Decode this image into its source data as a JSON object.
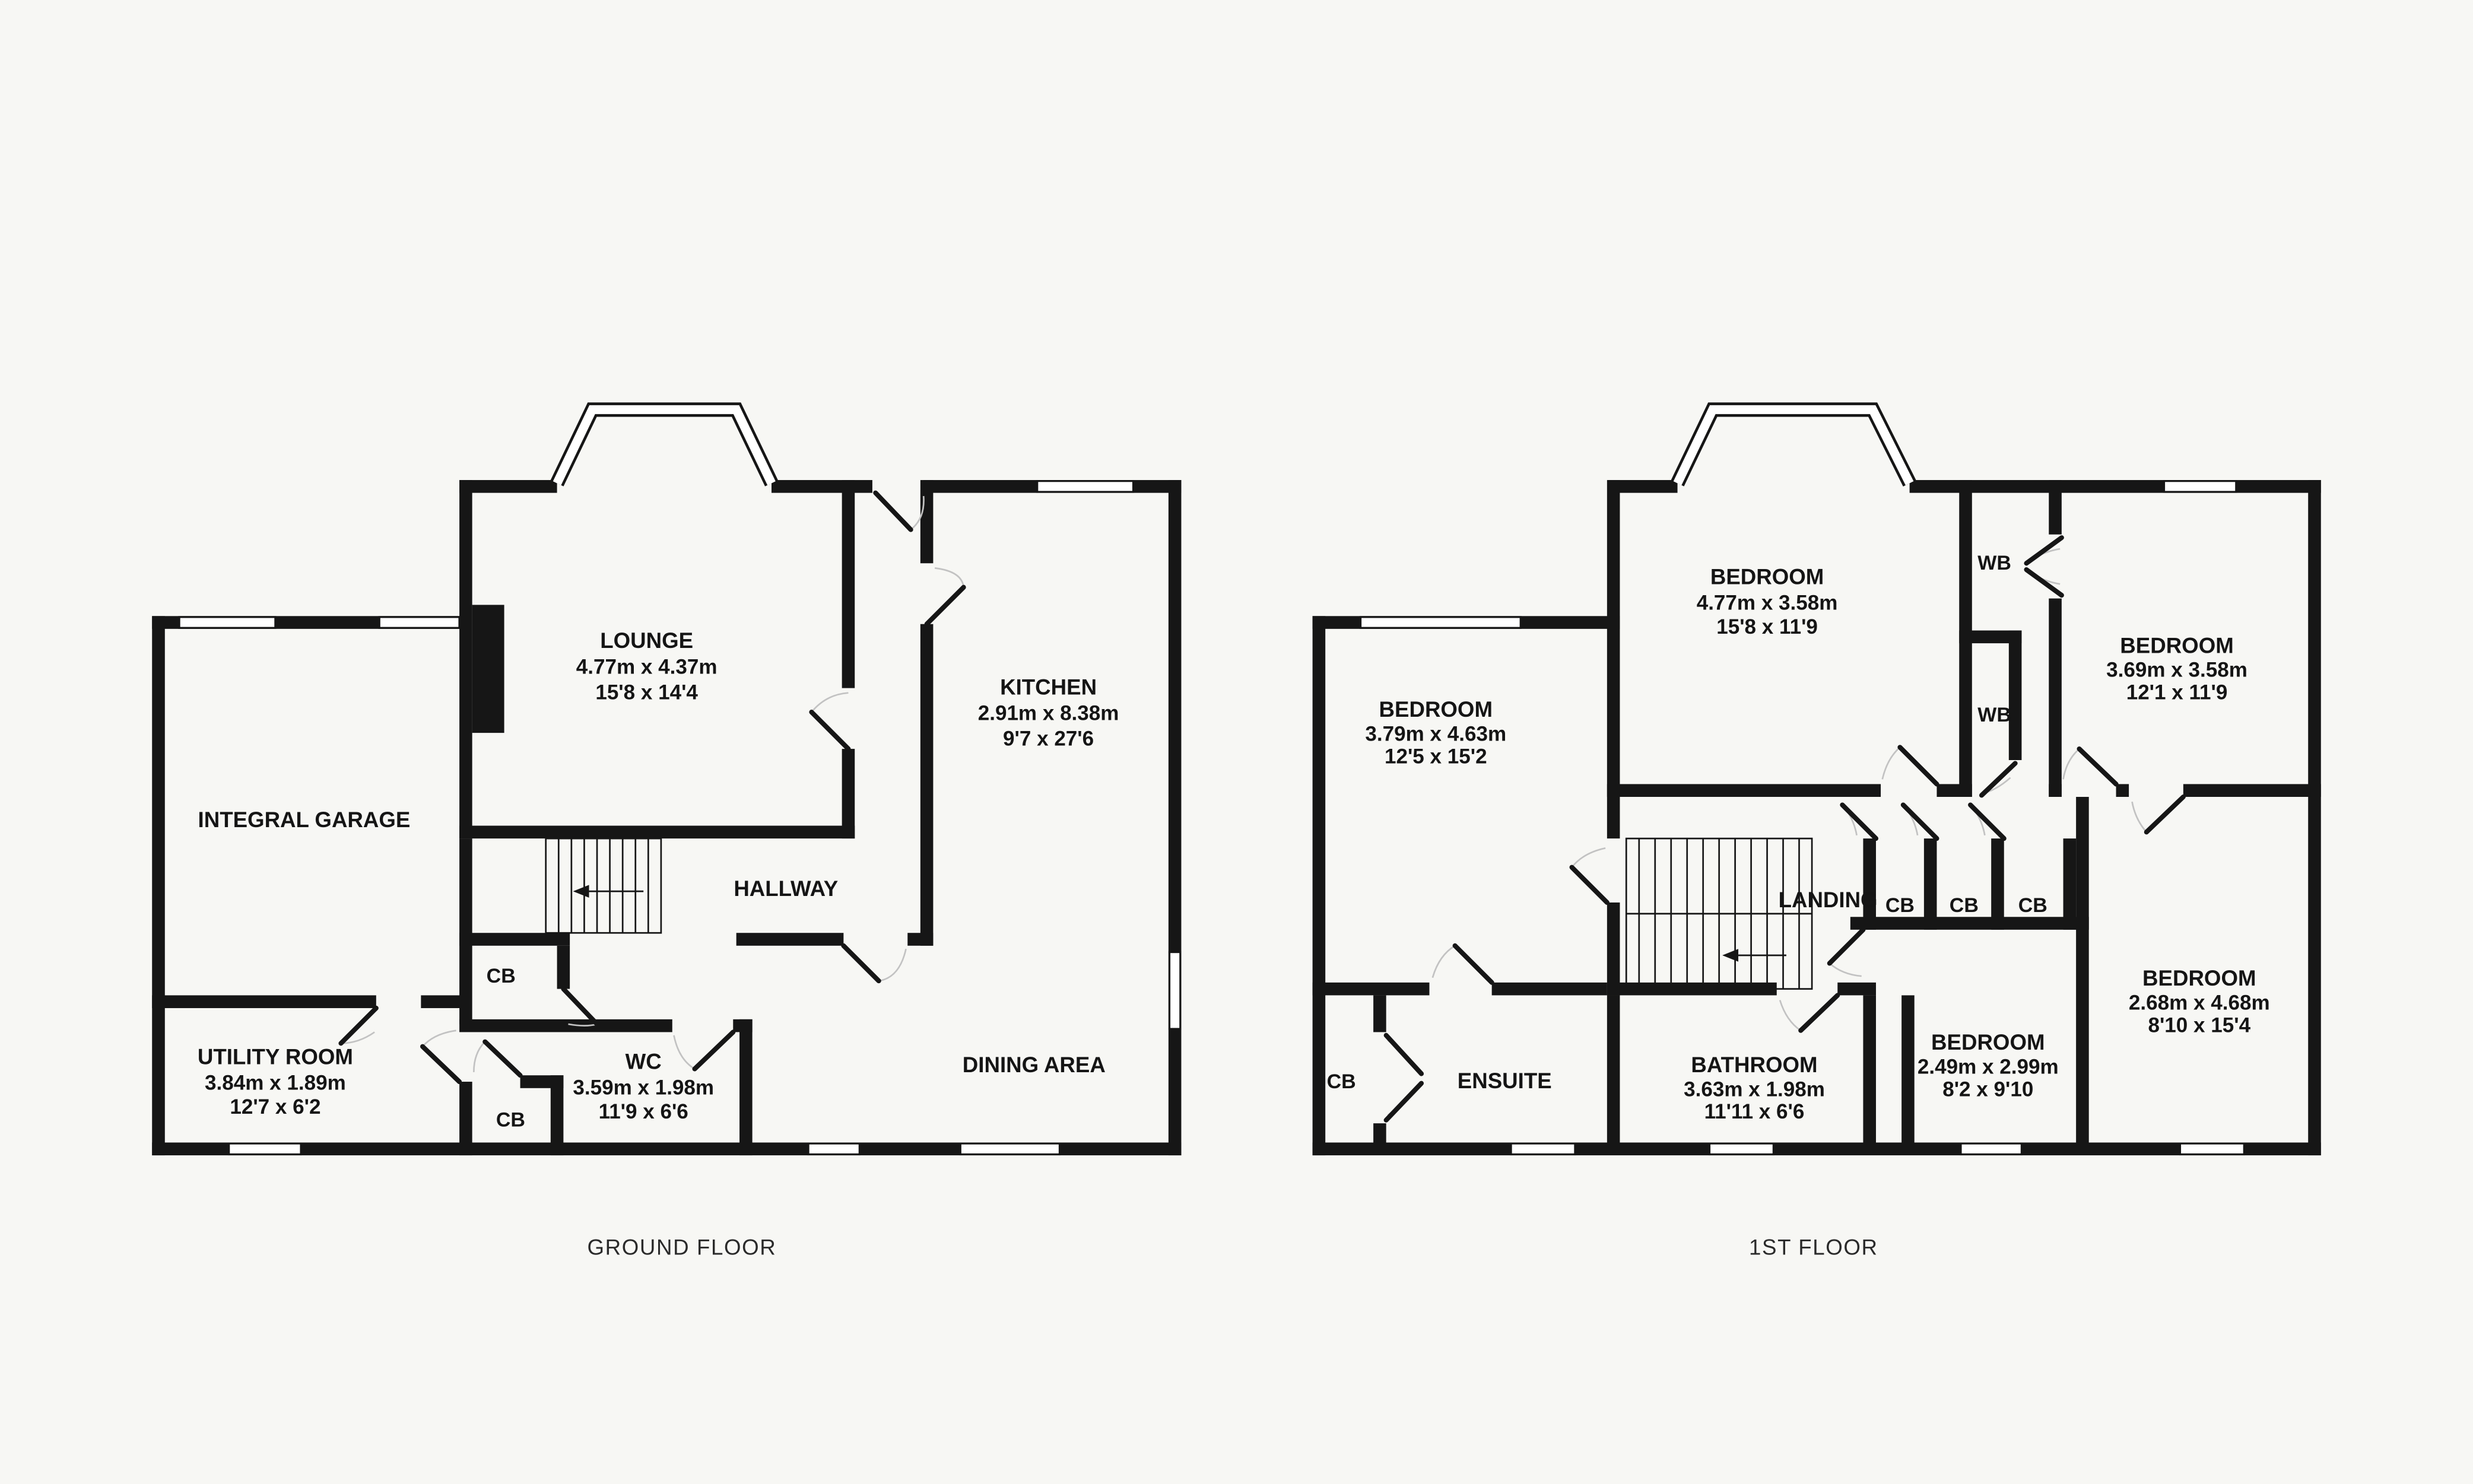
{
  "colors": {
    "background": "#f7f7f4",
    "wall": "#161616",
    "door_arc": "#c2c2c2"
  },
  "ground_floor": {
    "caption": "GROUND FLOOR",
    "rooms": {
      "lounge": {
        "name": "LOUNGE",
        "metric": "4.77m x 4.37m",
        "imperial": "15'8 x 14'4"
      },
      "kitchen": {
        "name": "KITCHEN",
        "metric": "2.91m x 8.38m",
        "imperial": "9'7 x 27'6"
      },
      "integral_garage": {
        "name": "INTEGRAL GARAGE"
      },
      "hallway": {
        "name": "HALLWAY"
      },
      "utility_room": {
        "name": "UTILITY ROOM",
        "metric": "3.84m x 1.89m",
        "imperial": "12'7 x 6'2"
      },
      "wc": {
        "name": "WC",
        "metric": "3.59m x 1.98m",
        "imperial": "11'9 x 6'6"
      },
      "dining_area": {
        "name": "DINING AREA"
      }
    },
    "cupboards": [
      "CB",
      "CB"
    ]
  },
  "first_floor": {
    "caption": "1ST FLOOR",
    "rooms": {
      "bedroom_center": {
        "name": "BEDROOM",
        "metric": "4.77m x 3.58m",
        "imperial": "15'8 x 11'9"
      },
      "bedroom_right_top": {
        "name": "BEDROOM",
        "metric": "3.69m x 3.58m",
        "imperial": "12'1 x 11'9"
      },
      "bedroom_left": {
        "name": "BEDROOM",
        "metric": "3.79m x 4.63m",
        "imperial": "12'5 x 15'2"
      },
      "bedroom_mid_bottom": {
        "name": "BEDROOM",
        "metric": "2.49m x 2.99m",
        "imperial": "8'2 x 9'10"
      },
      "bedroom_right_bottom": {
        "name": "BEDROOM",
        "metric": "2.68m x 4.68m",
        "imperial": "8'10 x 15'4"
      },
      "bathroom": {
        "name": "BATHROOM",
        "metric": "3.63m x 1.98m",
        "imperial": "11'11 x 6'6"
      },
      "ensuite": {
        "name": "ENSUITE"
      },
      "landing": {
        "name": "LANDING"
      }
    },
    "wardrobes": [
      "WB",
      "WB"
    ],
    "cupboards": [
      "CB",
      "CB",
      "CB"
    ],
    "cupboard_ensuite": "CB"
  }
}
